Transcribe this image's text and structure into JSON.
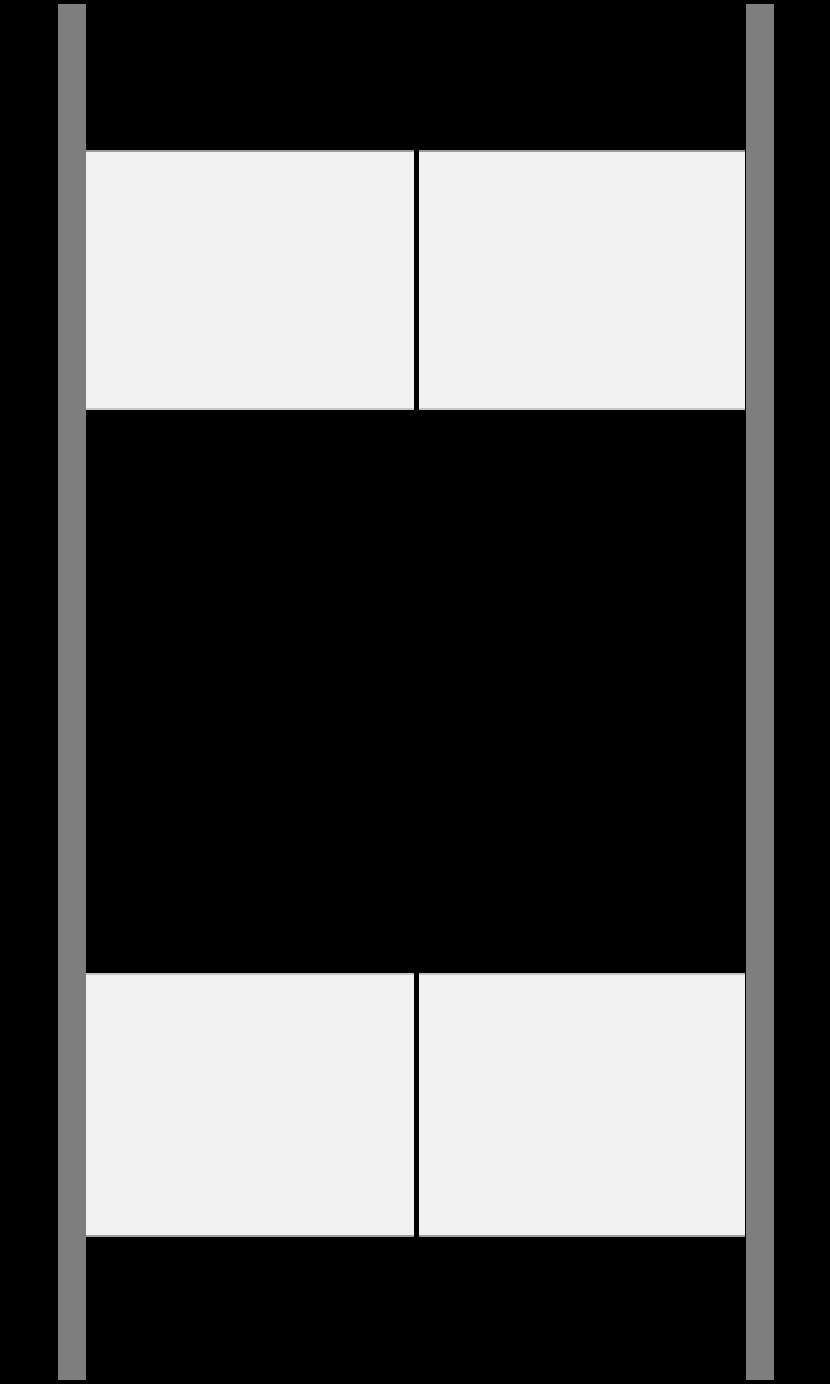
{
  "window": {
    "width_px": 830,
    "height_px": 1384
  },
  "colors": {
    "background": "#000000",
    "rail": "#7e7e7e",
    "panel_fill": "#f1f1f1",
    "panel_border_dark": "#9b9b9b",
    "panel_border_light": "#c6c6c6"
  },
  "rails": [
    {
      "id": "left-rail",
      "side": "left"
    },
    {
      "id": "right-rail",
      "side": "right"
    }
  ],
  "panels": [
    {
      "id": "panel-top-left",
      "row": 1,
      "col": 1,
      "text": ""
    },
    {
      "id": "panel-top-right",
      "row": 1,
      "col": 2,
      "text": ""
    },
    {
      "id": "panel-bottom-left",
      "row": 2,
      "col": 1,
      "text": ""
    },
    {
      "id": "panel-bottom-right",
      "row": 2,
      "col": 2,
      "text": ""
    }
  ]
}
